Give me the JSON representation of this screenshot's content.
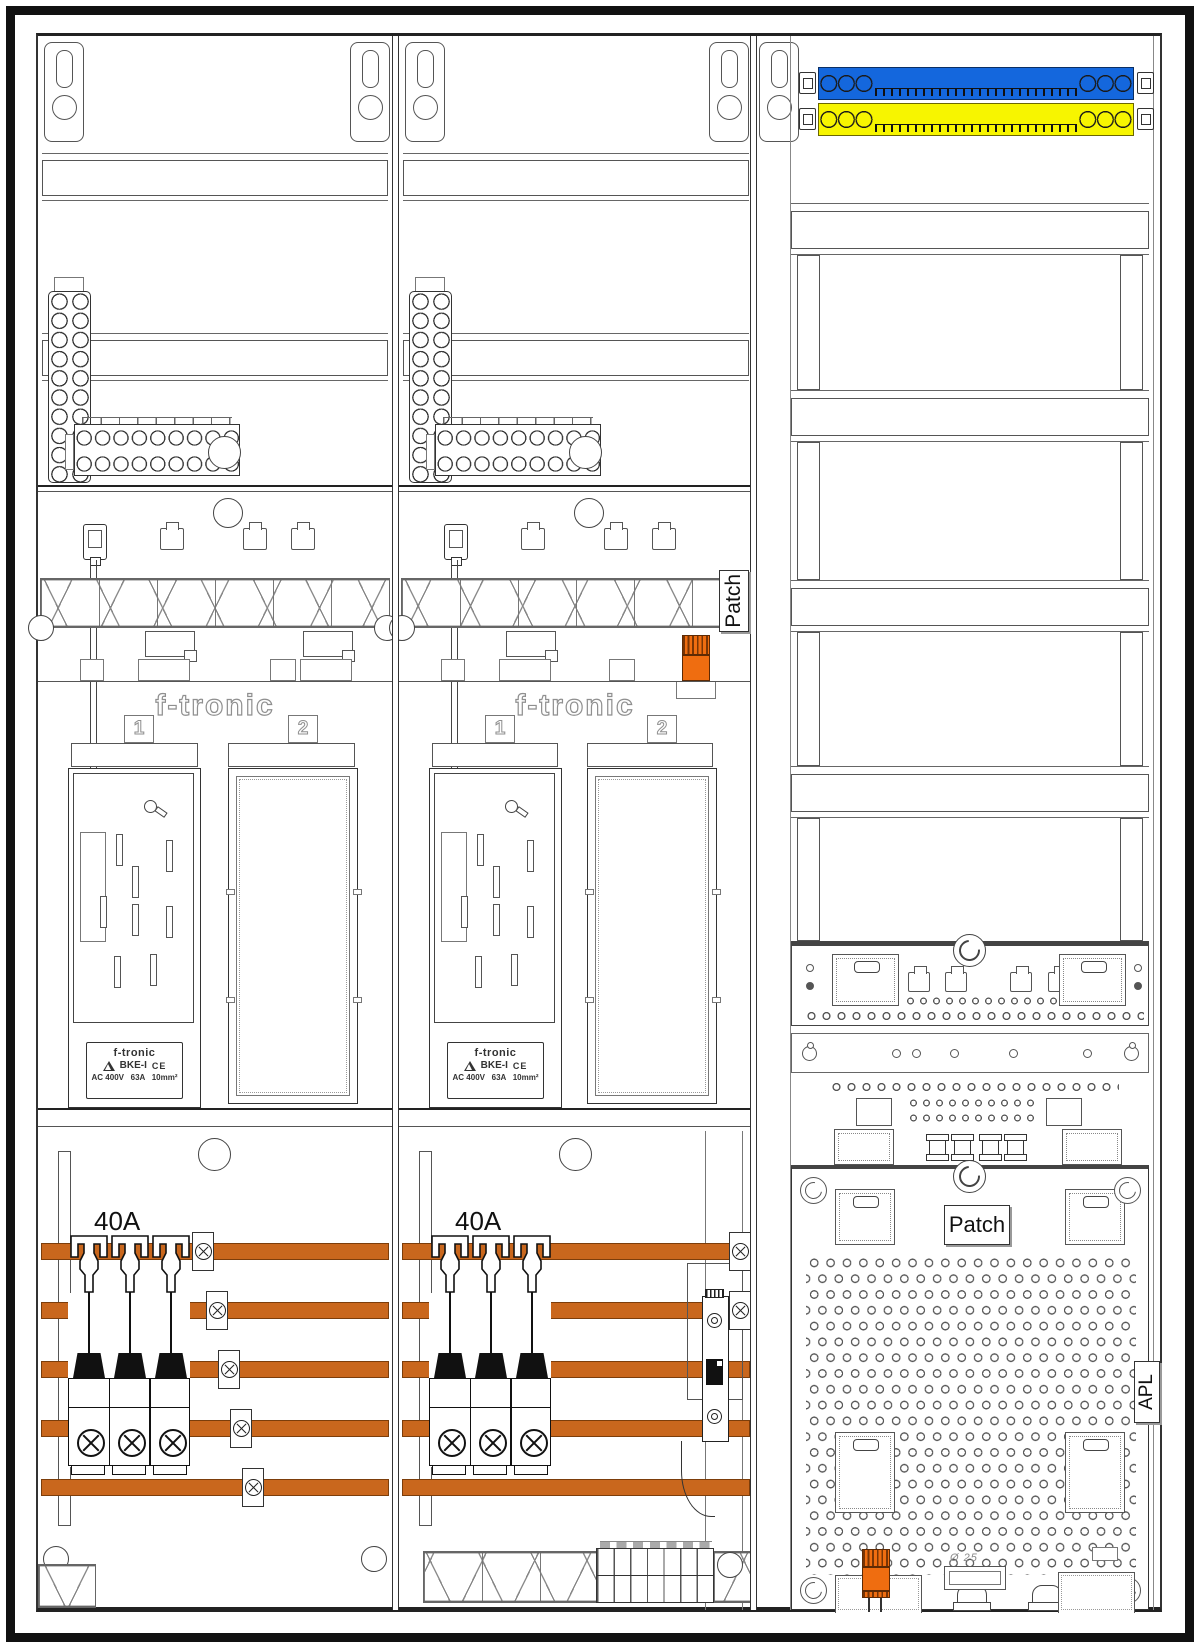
{
  "drawing": {
    "type": "meter-cabinet-installation-diagram",
    "patch_rail_label": "Patch",
    "patch_panel_label": "Patch",
    "apl_label": "APL",
    "gland_label": "Ø 25",
    "fields": [
      {
        "brand": "f-tronic",
        "slot1": "1",
        "slot2": "2",
        "breaker_rating": "40A",
        "meter_label": {
          "brand": "f-tronic",
          "model": "BKE-I",
          "ce_mark": "CE",
          "ratings": "AC 400V   63A   10mm²"
        }
      },
      {
        "brand": "f-tronic",
        "slot1": "1",
        "slot2": "2",
        "breaker_rating": "40A",
        "meter_label": {
          "brand": "f-tronic",
          "model": "BKE-I",
          "ce_mark": "CE",
          "ratings": "AC 400V   63A   10mm²"
        }
      }
    ],
    "colors": {
      "busbar_orange": "#c9671d",
      "connector_orange": "#ef6d10",
      "neutral_bar_blue": "#1467dd",
      "pe_bar_yellow": "#f7f500",
      "line_dark": "#222222",
      "line_mid": "#555555"
    }
  }
}
